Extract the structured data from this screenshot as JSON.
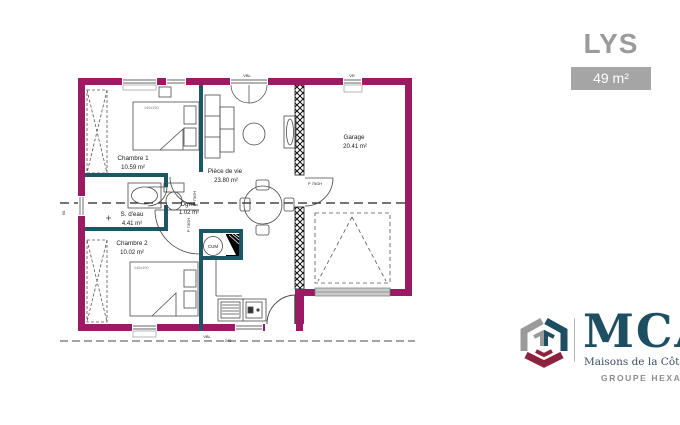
{
  "header": {
    "title": "LYS",
    "area_badge": "49 m²"
  },
  "plan": {
    "rooms": [
      {
        "name": "Chambre 1",
        "area": "10.59 m²"
      },
      {
        "name": "S. d'eau",
        "area": "4.41 m²"
      },
      {
        "name": "Dgmt",
        "area": "1.02 m²"
      },
      {
        "name": "Chambre 2",
        "area": "10.02 m²"
      },
      {
        "name": "Pièce de vie",
        "area": "23.80 m²"
      },
      {
        "name": "Garage",
        "area": "20.41 m²"
      }
    ],
    "labels": {
      "bed1": "140x190",
      "bed2": "140x190",
      "water_heater": "CUM",
      "door_chambre1": "P 73GH",
      "door_chambre2": "P 73GH",
      "door_garage": "P 75GH",
      "window_living": "VBL",
      "window_garage": "VR",
      "window_bottom": "VBL",
      "dim_bottom": "240",
      "dim_left": "90"
    },
    "colors": {
      "exterior_wall": "#9A1B63",
      "partition": "#1D5766"
    }
  },
  "logo": {
    "name": "MCA",
    "subtitle": "Maisons de la Côte Atlantique",
    "group": "GROUPE HEXAÔM"
  }
}
